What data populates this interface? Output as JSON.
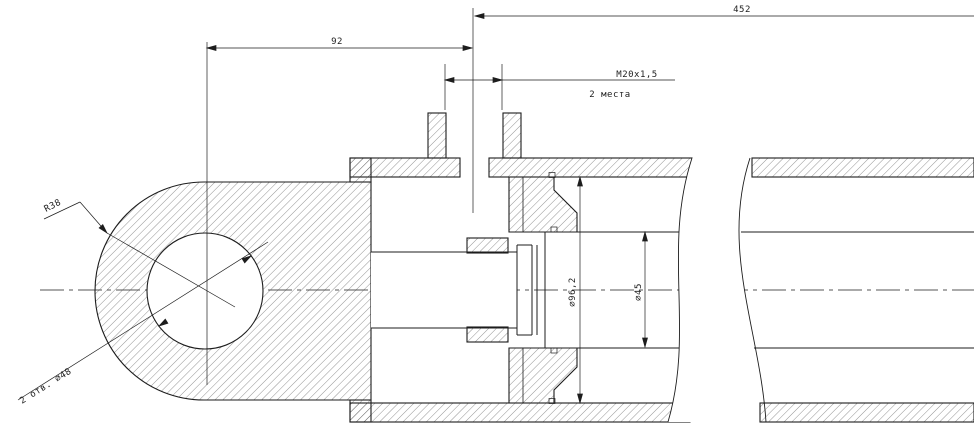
{
  "drawing": {
    "kind": "hydraulic-cylinder-longitudinal-section",
    "background": "#ffffff",
    "line_color": "#1d1d1d",
    "labels": {
      "dim_overall": "452",
      "dim_eye_to_port": "92",
      "port_thread": "M20x1,5",
      "port_places": "2 места",
      "bore_diameter": "∅96,2",
      "rod_diameter": "∅45",
      "eye_radius": "R38",
      "eye_holes": "2 отв. ∅48"
    }
  }
}
